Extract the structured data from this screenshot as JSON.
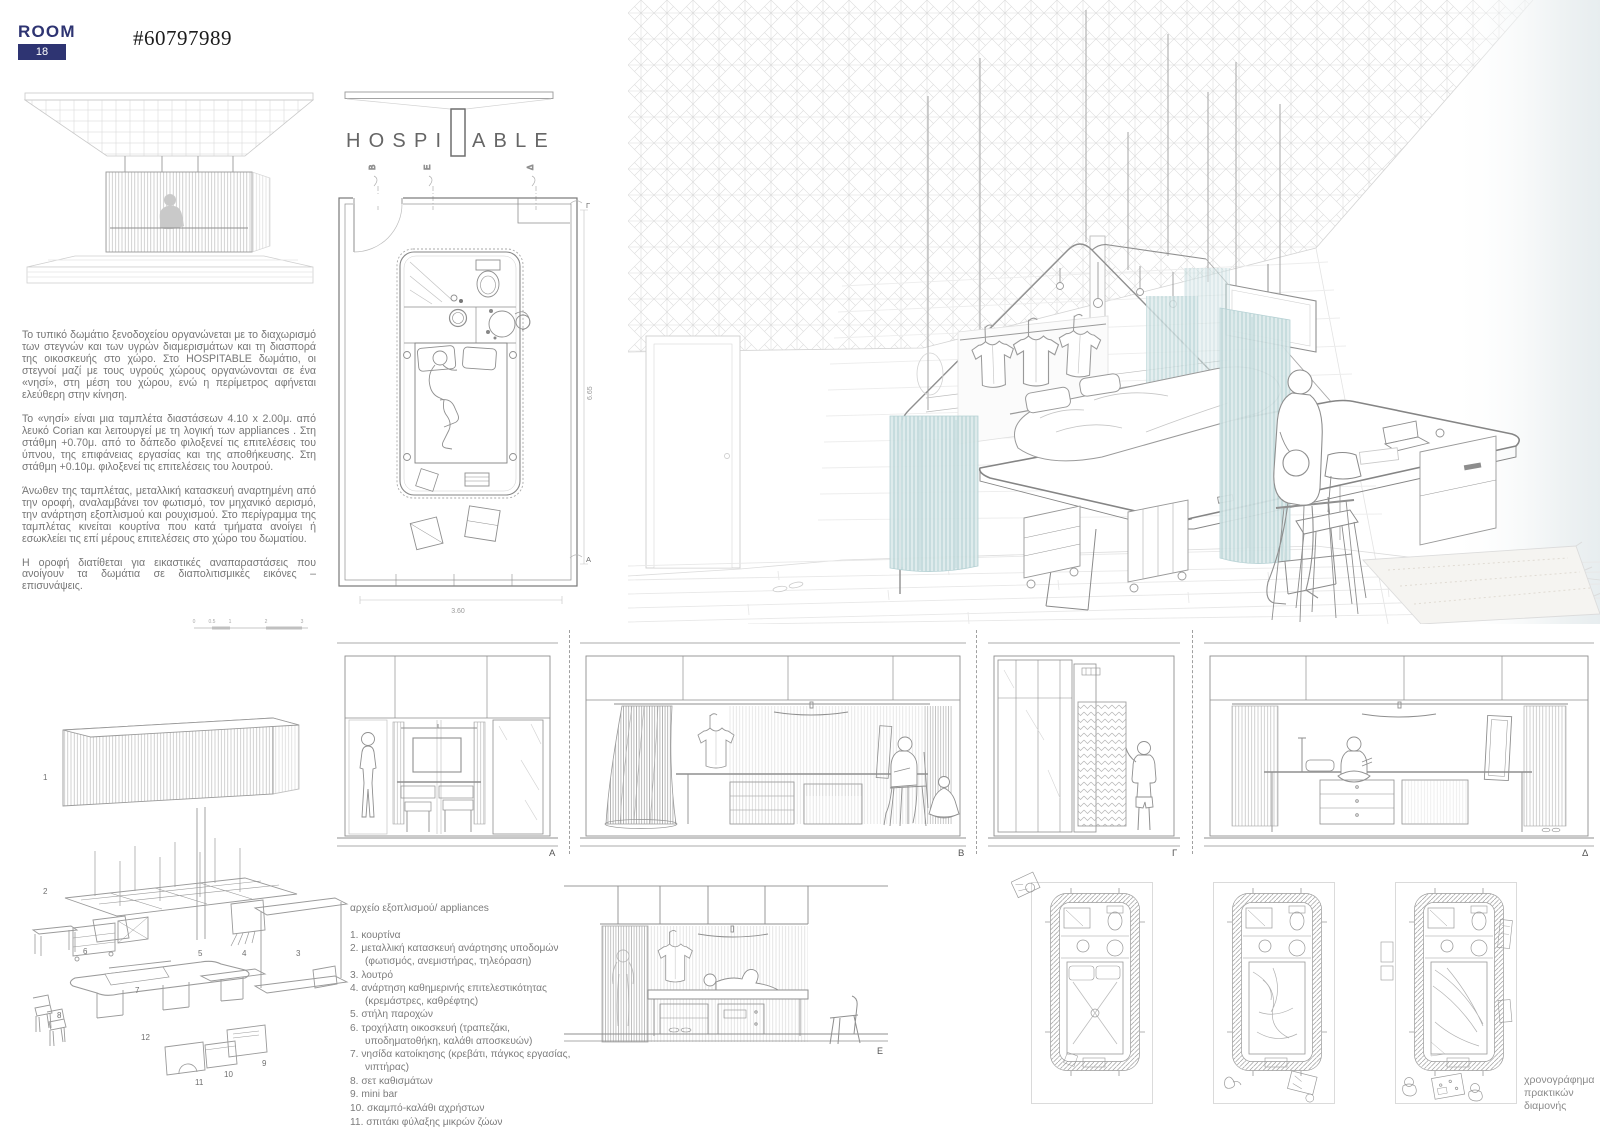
{
  "header": {
    "room_label": "ROOM",
    "room_number": "18",
    "entry_id": "#60797989"
  },
  "title": {
    "part1": "HOSPI",
    "part2": "ABLE"
  },
  "intro": {
    "paragraphs": [
      "Το τυπικό δωμάτιο ξενοδοχείου οργανώνεται με το διαχωρισμό των στεγνών και των υγρών διαμερισμάτων και τη διασπορά της οικοσκευής στο χώρο. Στο HOSPITABLE δωμάτιο, οι στεγνοί μαζί με τους υγρούς χώρους οργανώνονται σε ένα «νησί», στη μέση του χώρου, ενώ η περίμετρος αφήνεται ελεύθερη στην κίνηση.",
      "Το «νησί» είναι μια ταμπλέτα διαστάσεων 4.10 x 2.00μ. από λευκό Corian και λειτουργεί με τη λογική των appliances . Στη στάθμη +0.70μ. από το δάπεδο φιλοξενεί τις επιτελέσεις του ύπνου, της επιφάνειας εργασίας και της αποθήκευσης. Στη στάθμη +0.10μ. φιλοξενεί τις επιτελέσεις του λουτρού.",
      "Άνωθεν της ταμπλέτας, μεταλλική κατασκευή αναρτημένη από την οροφή, αναλαμβάνει τον φωτισμό, τον μηχανικό αερισμό, την ανάρτηση εξοπλισμού και ρουχισμού. Στο περίγραμμα της ταμπλέτας κινείται κουρτίνα που κατά τμήματα ανοίγει ή εσωκλείει τις επί μέρους επιτελέσεις στο χώρο του δωματίου.",
      "Η οροφή διατίθεται για εικαστικές αναπαραστάσεις που ανοίγουν τα δωμάτια σε διαπολιτισμικές εικόνες – επισυνάψεις."
    ]
  },
  "scalebar": {
    "ticks": [
      "0",
      "0.5",
      "1",
      "2",
      "3"
    ]
  },
  "plan": {
    "section_markers_top": [
      "Β",
      "Ε",
      "Δ"
    ],
    "marker_right_top": "Γ",
    "marker_right_bottom": "Α",
    "dim_height": "6.65",
    "dim_width": "3.60"
  },
  "appliances": {
    "heading": "αρχείο εξοπλισμού/ appliances",
    "items": [
      "1. κουρτίνα",
      "2. μεταλλική κατασκευή ανάρτησης υποδομών (φωτισμός, ανεμιστήρας, τηλεόραση)",
      "3. λουτρό",
      "4. ανάρτηση καθημερινής επιτελεστικότητας (κρεμάστρες, καθρέφτης)",
      "5. στήλη παροχών",
      "6. τροχήλατη οικοσκευή (τραπεζάκι, υποδηματοθήκη, καλάθι αποσκευών)",
      "7. νησίδα κατοίκησης (κρεβάτι, πάγκος εργασίας, νιπτήρας)",
      "8. σετ καθισμάτων",
      "9. mini bar",
      "10. σκαμπό-καλάθι αχρήστων",
      "11. σπιτάκι φύλαξης μικρών ζώων",
      "12. μεταλλική στήριξη υποδομής"
    ]
  },
  "exploded": {
    "numbers": [
      "1",
      "2",
      "3",
      "4",
      "5",
      "6",
      "7",
      "8",
      "9",
      "10",
      "11",
      "12"
    ]
  },
  "elevations": {
    "labels": [
      "Α",
      "Β",
      "Γ",
      "Δ"
    ],
    "label_e": "Ε"
  },
  "chronogram": {
    "lines": [
      "χρονογράφημα",
      "πρακτικών",
      "διαμονής"
    ]
  },
  "colors": {
    "accent_navy": "#2e3472",
    "curtain_teal": "#ddeaeb",
    "line_gray": "#9a9a9a"
  }
}
